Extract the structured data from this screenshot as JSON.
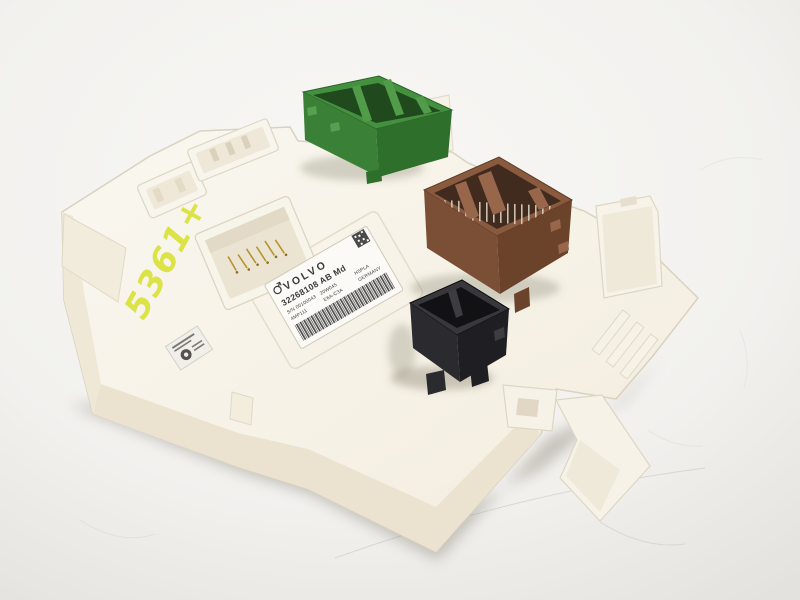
{
  "colors": {
    "background": "#f2f1ef",
    "module_body": "#f6f2e7",
    "module_side": "#ebe2d0",
    "green_connector": {
      "rim": "#43903f",
      "interior": "#20491d",
      "left": "#3a8036",
      "right": "#2f6f2c",
      "wall": "#519c49"
    },
    "brown_connector": {
      "rim": "#8a5a3e",
      "interior": "#412b1f",
      "left": "#7b4f35",
      "right": "#6b422a",
      "wall": "#97664b",
      "pins": "#d8d0c2"
    },
    "black_connector": {
      "rim": "#37373c",
      "interior": "#121215",
      "left": "#2b2b2f",
      "right": "#1f1f23",
      "wall": "#3c3c41"
    },
    "label_bg": "#fbfaf6",
    "label_text": "#3b3b3b",
    "marker": "#d9e23a"
  },
  "label": {
    "brand": "VOLVO",
    "part_number": "32268108 AB Md",
    "serial": "S/N 00100043",
    "code_left": "4MP111",
    "date_code": "20W045",
    "hw_code": "E6A-C3A",
    "plant_code": "H5PLA",
    "country": "GERMANY"
  },
  "handwritten_marking": "5361+"
}
